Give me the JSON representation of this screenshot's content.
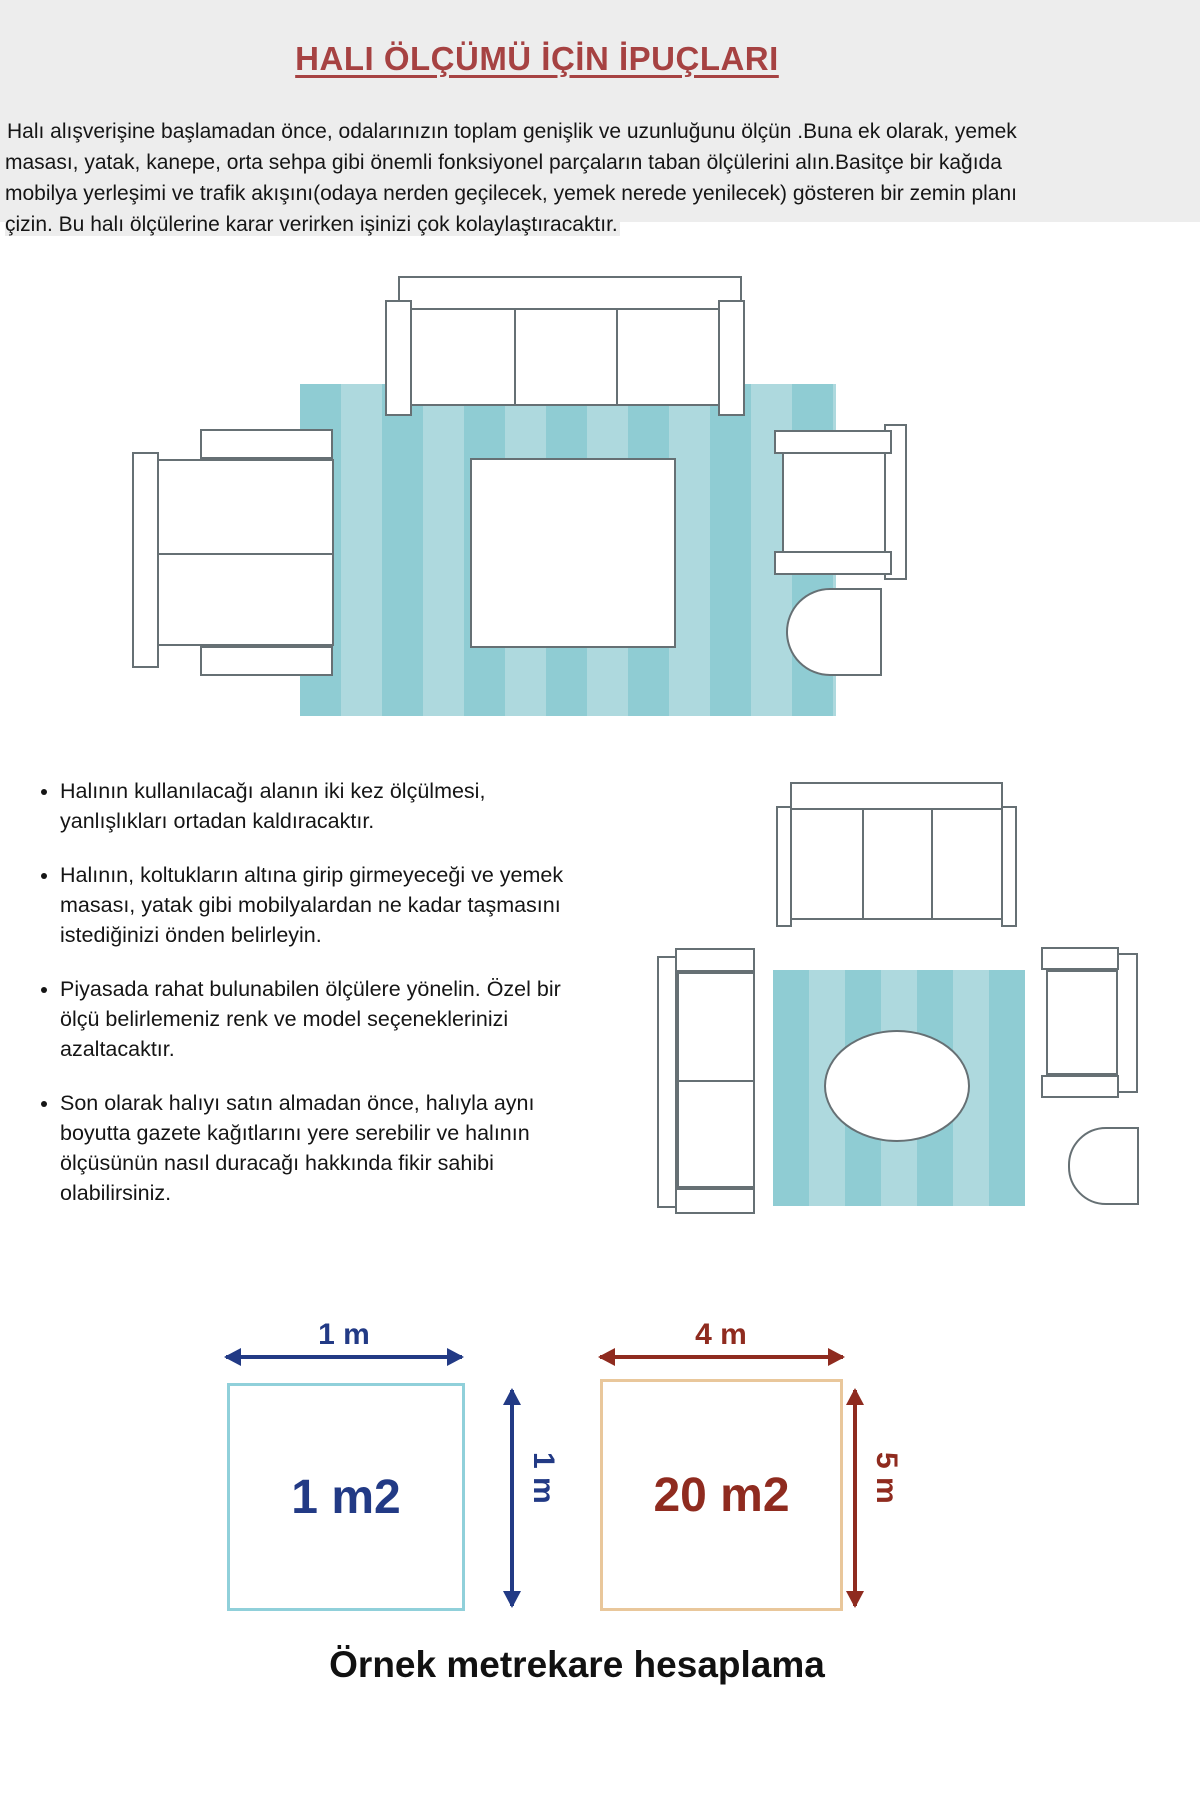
{
  "page": {
    "title": "HALI ÖLÇÜMÜ İÇİN İPUÇLARI",
    "intro": "Halı alışverişine başlamadan önce, odalarınızın toplam genişlik ve uzunluğunu ölçün .Buna ek olarak, yemek\nmasası, yatak, kanepe, orta sehpa gibi önemli fonksiyonel parçaların taban ölçülerini alın.Basitçe bir kağıda\nmobilya yerleşimi ve trafik akışını(odaya nerden geçilecek, yemek nerede yenilecek) gösteren bir zemin planı\nçizin. Bu halı ölçülerine karar verirken işinizi çok kolaylaştıracaktır.",
    "tips": [
      "Halının kullanılacağı alanın iki kez ölçülmesi,\nyanlışlıkları ortadan kaldıracaktır.",
      "Halının, koltukların altına girip girmeyeceği ve yemek\nmasası, yatak gibi mobilyalardan ne kadar taşmasını\nistediğinizi önden belirleyin.",
      "Piyasada rahat bulunabilen ölçülere yönelin. Özel bir\nölçü belirlemeniz renk ve model seçeneklerinizi\nazaltacaktır.",
      "Son olarak halıyı satın almadan önce, halıyla aynı\nboyutta gazete kağıtlarını yere serebilir ve halının\nölçüsünün nasıl duracağı hakkında fikir sahibi\nolabilirsiniz."
    ]
  },
  "example": {
    "left_square": {
      "width_label": "1 m",
      "height_label": "1 m",
      "area_label": "1 m2"
    },
    "right_square": {
      "width_label": "4 m",
      "height_label": "5 m",
      "area_label": "20 m2"
    },
    "caption": "Örnek metrekare hesaplama"
  },
  "colors": {
    "title_red": "#a64242",
    "navy": "#223a85",
    "dark_red": "#8f2b1f",
    "rug_stripe_dark": "#8fccd3",
    "rug_stripe_light": "#aed9de",
    "furniture_outline": "#667074",
    "left_square_border": "#90d0da",
    "right_square_border": "#e9c79b",
    "intro_band": "#ededed",
    "text": "#151515"
  }
}
